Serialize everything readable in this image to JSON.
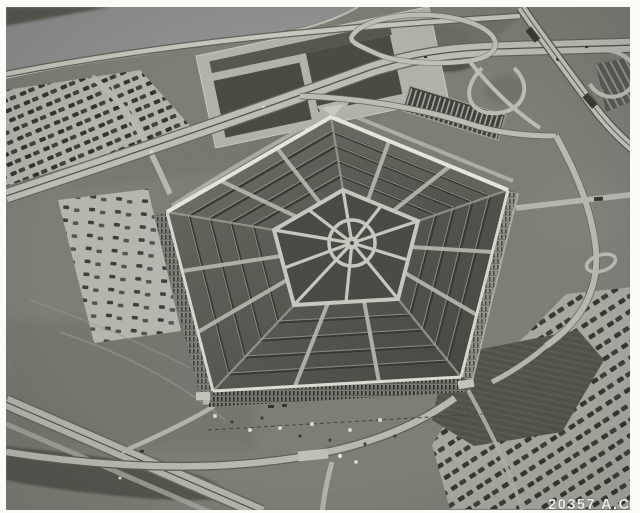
{
  "photo": {
    "id_label": "20357 A.C.",
    "subject": "Black-and-white oblique aerial photograph of the Pentagon building with surrounding highways, cloverleaf interchange, parking lots and the Potomac waterfront",
    "tones": {
      "frame": "#fbfbf8",
      "water": "#8d8d8d",
      "land": "#7b7b73",
      "roads": "#bdbdb5",
      "roof": "#4f4f49",
      "facade": "#77776f",
      "courtyard_lawn": "#454540",
      "walkways": "#c7c7bf",
      "id_text": "#ededea"
    }
  }
}
